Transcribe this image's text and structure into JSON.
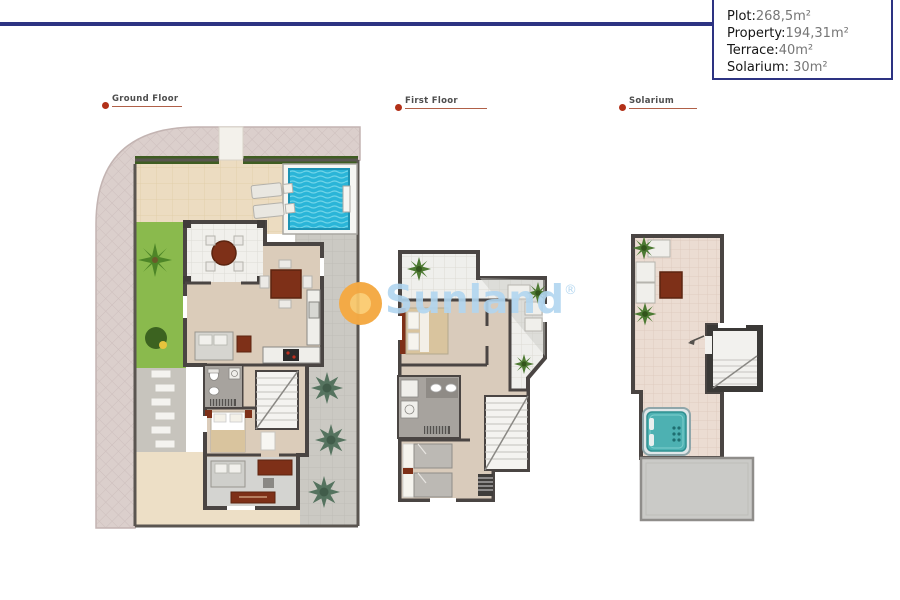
{
  "info_box": {
    "items": [
      {
        "label": "Plot:",
        "value": "268,5m²"
      },
      {
        "label": "Property:",
        "value": "194,31m²"
      },
      {
        "label": "Terrace:",
        "value": "40m²"
      },
      {
        "label": "Solarium:",
        "value": " 30m²"
      }
    ]
  },
  "sections": [
    {
      "label": "Ground Floor"
    },
    {
      "label": "First Floor"
    },
    {
      "label": "Solarium"
    }
  ],
  "watermark": {
    "text": "Sunland",
    "registered": "®"
  },
  "colors": {
    "header_line": "#2d3382",
    "info_border": "#2d3382",
    "label_dot": "#b23018",
    "label_underline": "#b06048",
    "watermark_blue": "#b0d5f0",
    "sun_orange": "#f2a23c",
    "pool_water": "#2ab5d8",
    "grass_green": "#8aba4d",
    "wall_gray": "#4a4543",
    "furniture_brown": "#7e3018"
  }
}
